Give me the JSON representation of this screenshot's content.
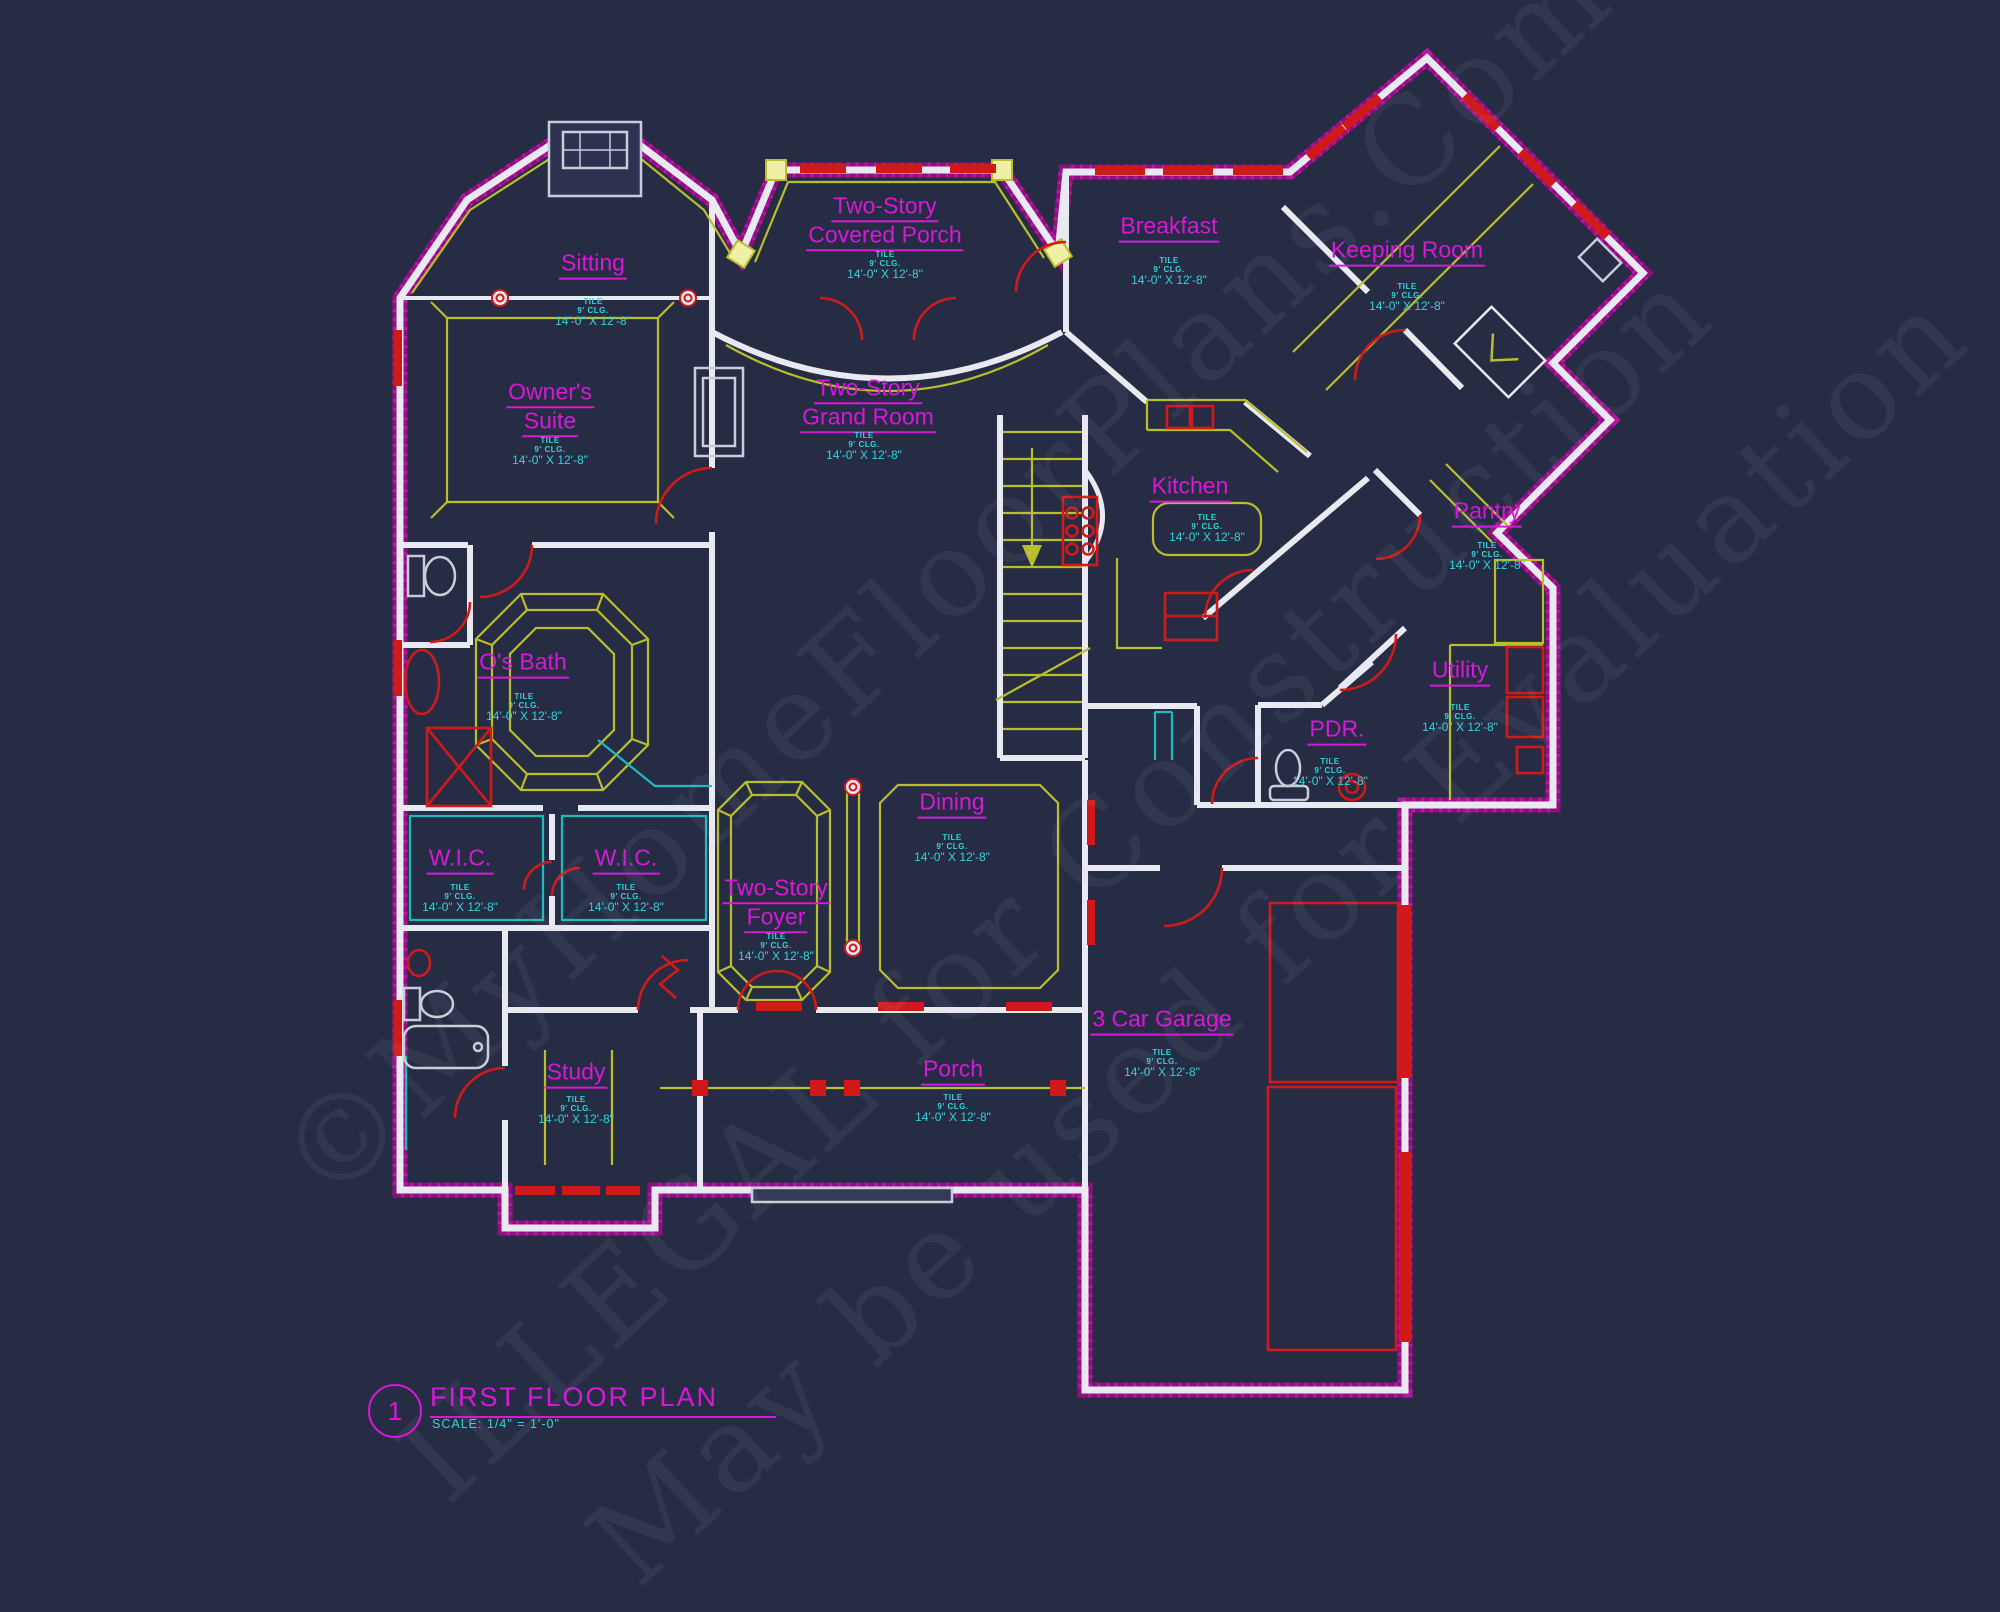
{
  "colors": {
    "background": "#272c45",
    "wall_white": "#e8e9f1",
    "exterior_magenta": "#a8119b",
    "room_label_magenta": "#d818d8",
    "dimension_cyan": "#35d2d8",
    "detail_yellow": "#b9be2c",
    "door_red": "#d01a1a",
    "closet_teal": "#1cbcbc"
  },
  "title_block": {
    "detail_number": "1",
    "title": "FIRST FLOOR PLAN",
    "scale": "SCALE: 1/4\" = 1'-0\""
  },
  "dim_block": {
    "material": "TILE",
    "ceiling": "9' CLG.",
    "size": "14'-0\" X 12'-8\""
  },
  "watermark": {
    "lines": [
      "©MyHomeFloorPlans.Com",
      "ILLEGAL for Construction",
      "May be used for Evaluation"
    ]
  },
  "rooms": [
    {
      "id": "sitting",
      "lines": [
        "Sitting"
      ],
      "x": 593,
      "y": 265,
      "dims": {
        "x": 593,
        "y": 313
      }
    },
    {
      "id": "owners-suite",
      "lines": [
        "Owner's",
        "Suite"
      ],
      "x": 550,
      "y": 408,
      "dims": {
        "x": 550,
        "y": 452
      }
    },
    {
      "id": "covered-porch",
      "lines": [
        "Two-Story",
        "Covered Porch"
      ],
      "x": 885,
      "y": 222,
      "dims": {
        "x": 885,
        "y": 266
      }
    },
    {
      "id": "breakfast",
      "lines": [
        "Breakfast"
      ],
      "x": 1169,
      "y": 228,
      "dims": {
        "x": 1169,
        "y": 272
      }
    },
    {
      "id": "keeping-room",
      "lines": [
        "Keeping Room"
      ],
      "x": 1407,
      "y": 252,
      "dims": {
        "x": 1407,
        "y": 298
      }
    },
    {
      "id": "grand-room",
      "lines": [
        "Two-Story",
        "Grand Room"
      ],
      "x": 868,
      "y": 404,
      "dims": {
        "x": 864,
        "y": 447
      }
    },
    {
      "id": "kitchen",
      "lines": [
        "Kitchen"
      ],
      "x": 1190,
      "y": 488,
      "dims": {
        "x": 1207,
        "y": 529
      }
    },
    {
      "id": "pantry",
      "lines": [
        "Pantry"
      ],
      "x": 1487,
      "y": 513,
      "dims": {
        "x": 1487,
        "y": 557
      }
    },
    {
      "id": "os-bath",
      "lines": [
        "O's Bath"
      ],
      "x": 523,
      "y": 664,
      "dims": {
        "x": 524,
        "y": 708
      }
    },
    {
      "id": "utility",
      "lines": [
        "Utility"
      ],
      "x": 1460,
      "y": 672,
      "dims": {
        "x": 1460,
        "y": 719
      }
    },
    {
      "id": "pdr",
      "lines": [
        "PDR."
      ],
      "x": 1337,
      "y": 731,
      "dims": {
        "x": 1330,
        "y": 773
      }
    },
    {
      "id": "dining",
      "lines": [
        "Dining"
      ],
      "x": 952,
      "y": 804,
      "dims": {
        "x": 952,
        "y": 849
      }
    },
    {
      "id": "wic-1",
      "lines": [
        "W.I.C."
      ],
      "x": 460,
      "y": 860,
      "dims": {
        "x": 460,
        "y": 899
      }
    },
    {
      "id": "wic-2",
      "lines": [
        "W.I.C."
      ],
      "x": 626,
      "y": 860,
      "dims": {
        "x": 626,
        "y": 899
      }
    },
    {
      "id": "foyer",
      "lines": [
        "Two-Story",
        "Foyer"
      ],
      "x": 776,
      "y": 904,
      "dims": {
        "x": 776,
        "y": 948
      }
    },
    {
      "id": "study",
      "lines": [
        "Study"
      ],
      "x": 576,
      "y": 1074,
      "dims": {
        "x": 576,
        "y": 1111
      }
    },
    {
      "id": "porch",
      "lines": [
        "Porch"
      ],
      "x": 953,
      "y": 1071,
      "dims": {
        "x": 953,
        "y": 1109
      }
    },
    {
      "id": "garage",
      "lines": [
        "3 Car Garage"
      ],
      "x": 1162,
      "y": 1021,
      "dims": {
        "x": 1162,
        "y": 1064
      }
    }
  ]
}
